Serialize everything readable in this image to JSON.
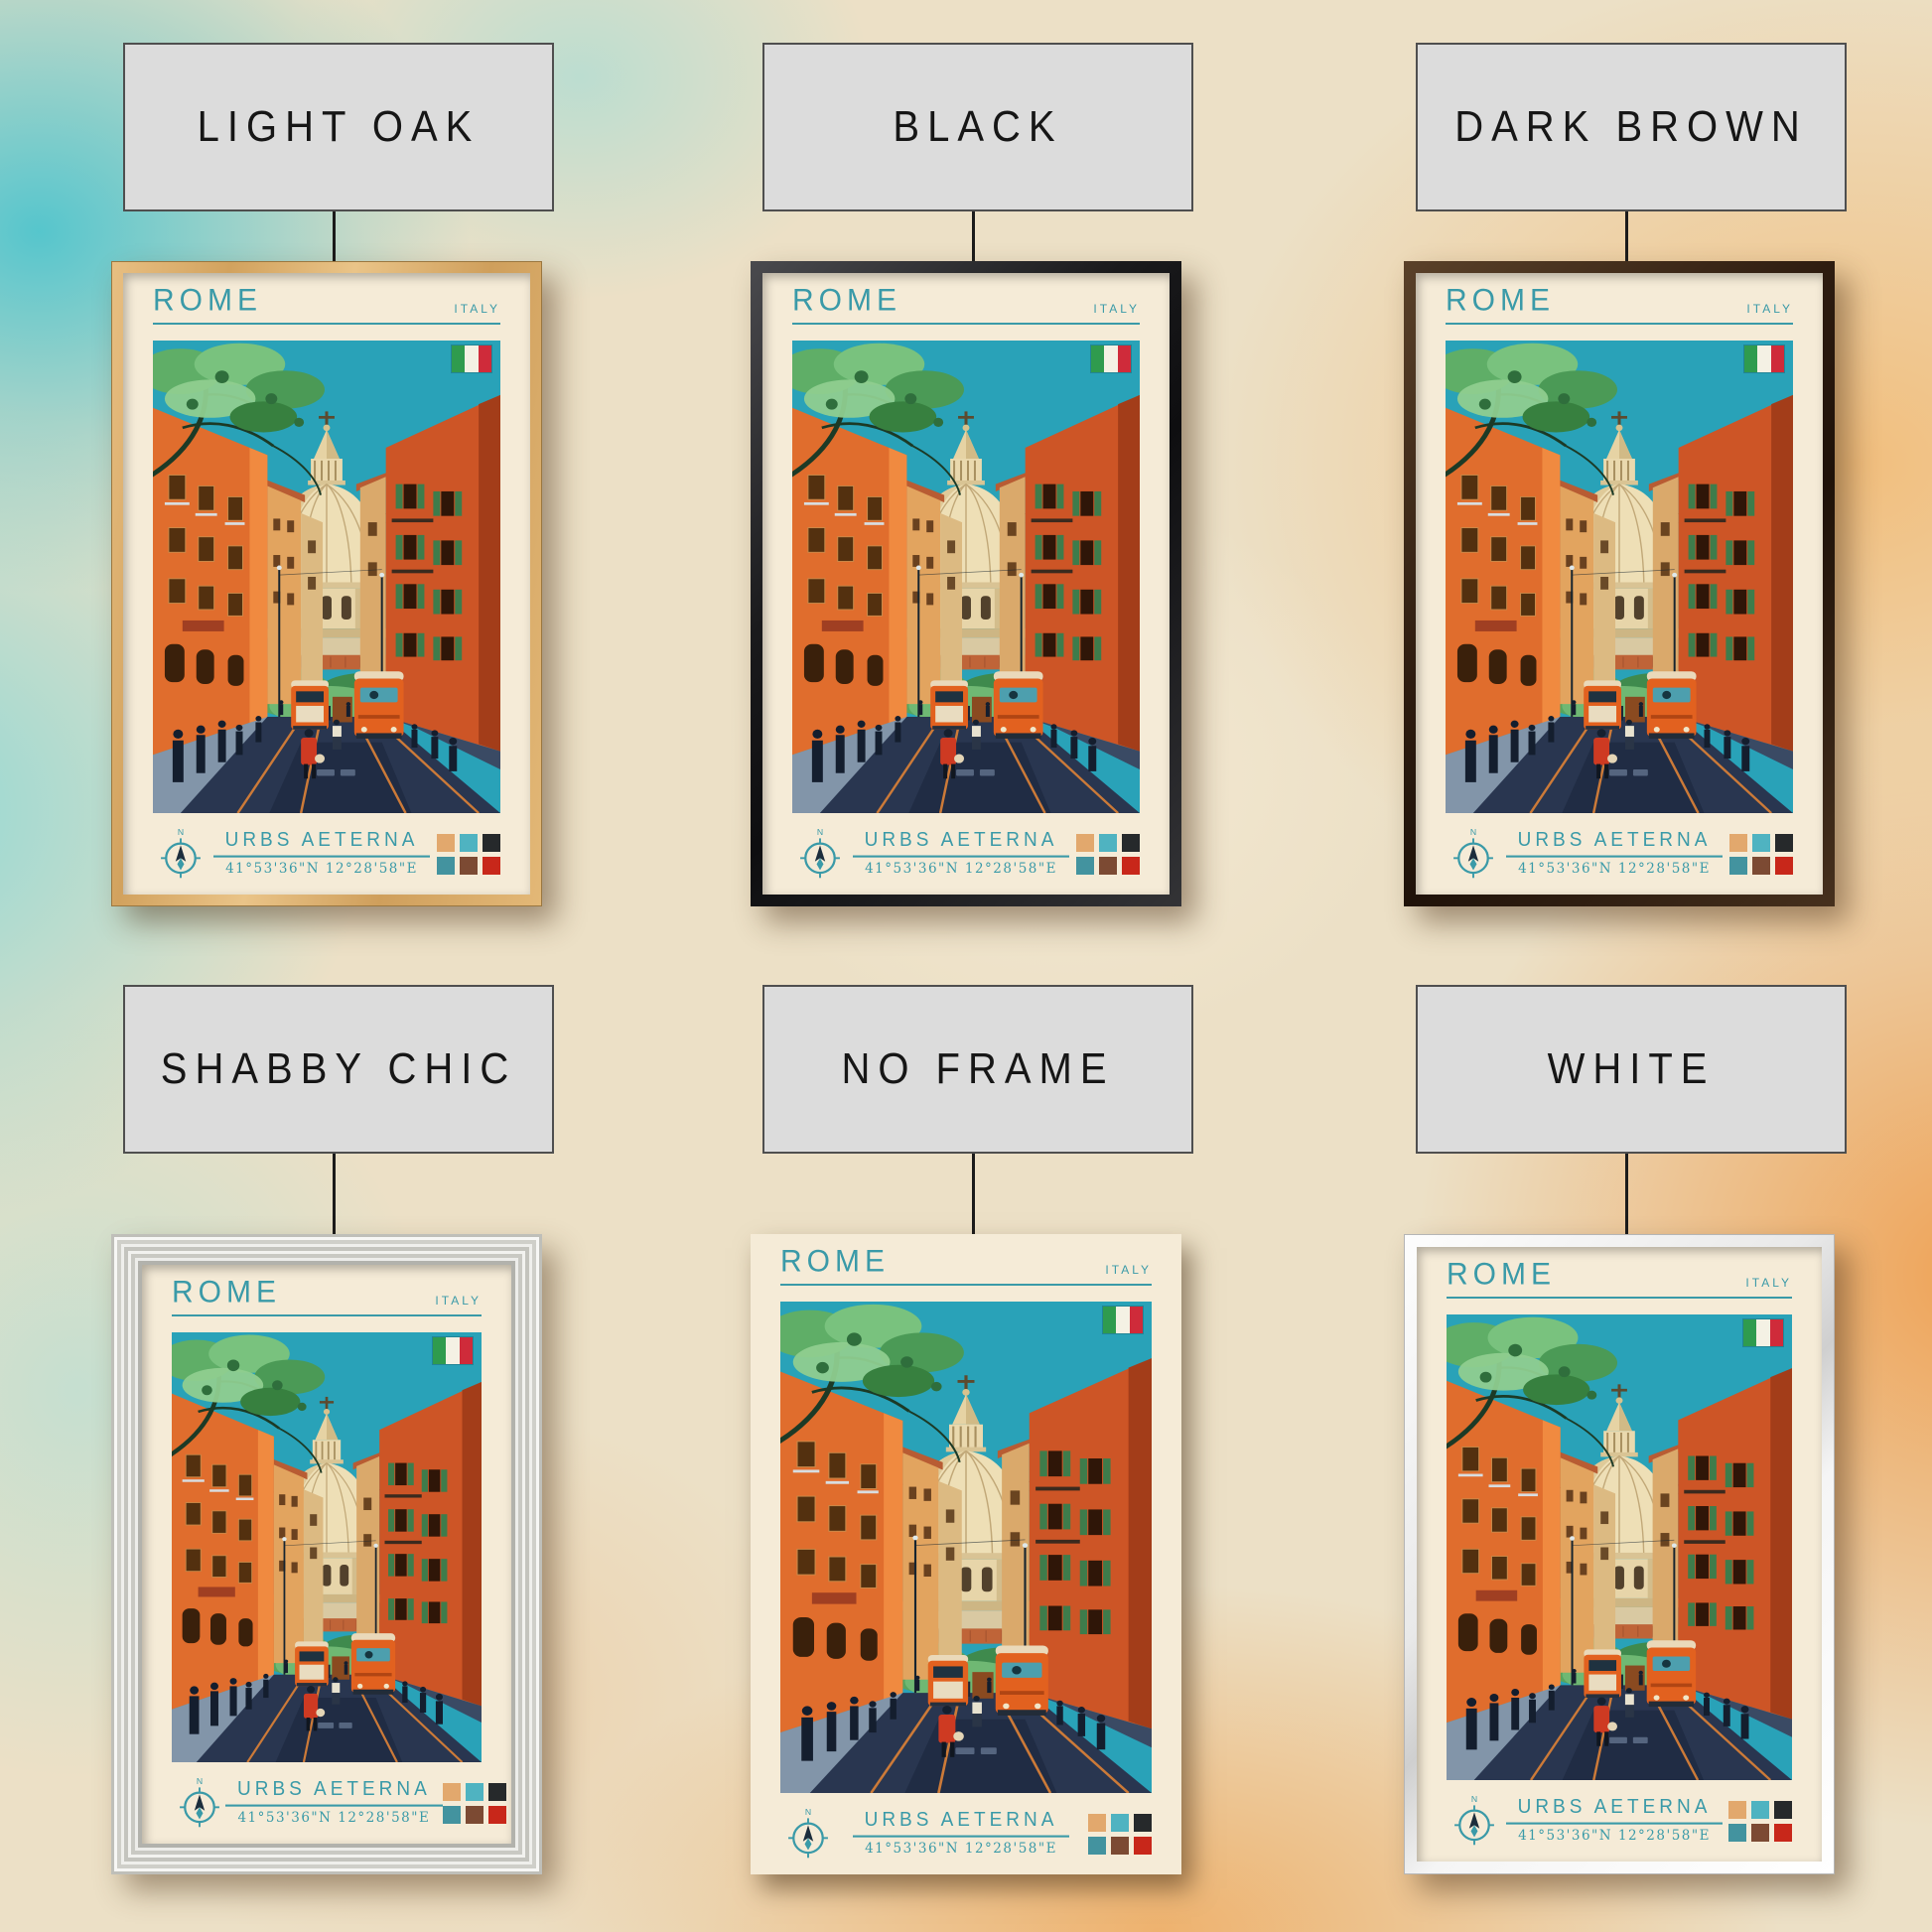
{
  "palette": {
    "accent_teal": "#3a9aa8",
    "paper": "#f5ebd7",
    "wall_left_tint": "#5ec4cd",
    "wall_right_tint": "#eda45e",
    "label_bg": "#dcdcdc"
  },
  "variants": [
    {
      "label": "LIGHT OAK",
      "frame": "light-oak"
    },
    {
      "label": "BLACK",
      "frame": "black"
    },
    {
      "label": "DARK BROWN",
      "frame": "dark-brown"
    },
    {
      "label": "SHABBY CHIC",
      "frame": "shabby-chic"
    },
    {
      "label": "NO FRAME",
      "frame": "no-frame"
    },
    {
      "label": "WHITE",
      "frame": "white"
    }
  ],
  "poster": {
    "title": "ROME",
    "country": "ITALY",
    "subtitle": "URBS AETERNA",
    "coordinates": "41°53'36\"N 12°28'58\"E",
    "compass_north": "N",
    "flag_colors": [
      "#2f9b4e",
      "#f4f1e4",
      "#cf2b3a"
    ],
    "swatches": [
      "#e2a86d",
      "#4fb3c1",
      "#26292b",
      "#43939f",
      "#7c4a33",
      "#c8271a"
    ]
  }
}
